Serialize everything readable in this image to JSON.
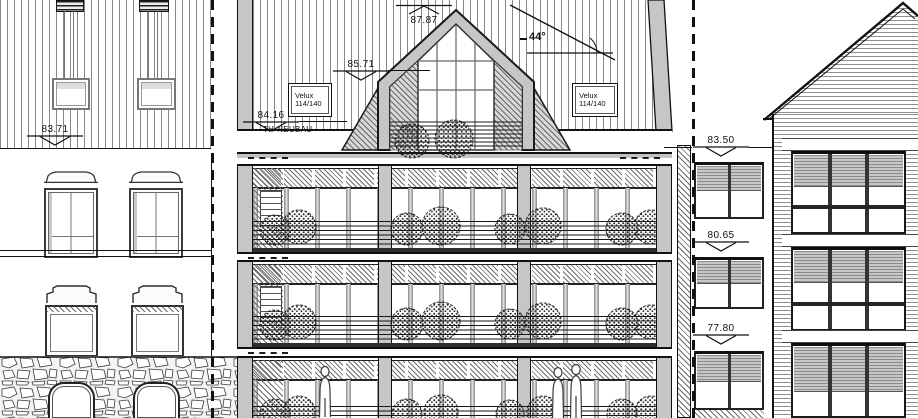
{
  "drawing_labels": {
    "building": "TH-NEUBAU",
    "roof_pitch": "44°"
  },
  "roof_window_label": {
    "line1": "Velux",
    "line2": "114/140"
  },
  "markers": {
    "dormer_ridge": "87.87",
    "main_ridge": "85.71",
    "neubau_eaves": "84.16",
    "left_building_eaves": "83.71",
    "right_level_upper": "83.50",
    "right_level_middle": "80.65",
    "right_level_lower": "77.80"
  },
  "colors": {
    "line": "#1a1a1a",
    "wall_gray": "#c6c6c6",
    "hatch_gray": "#6a6a6a",
    "shade_gray": "#b5b5b5"
  }
}
